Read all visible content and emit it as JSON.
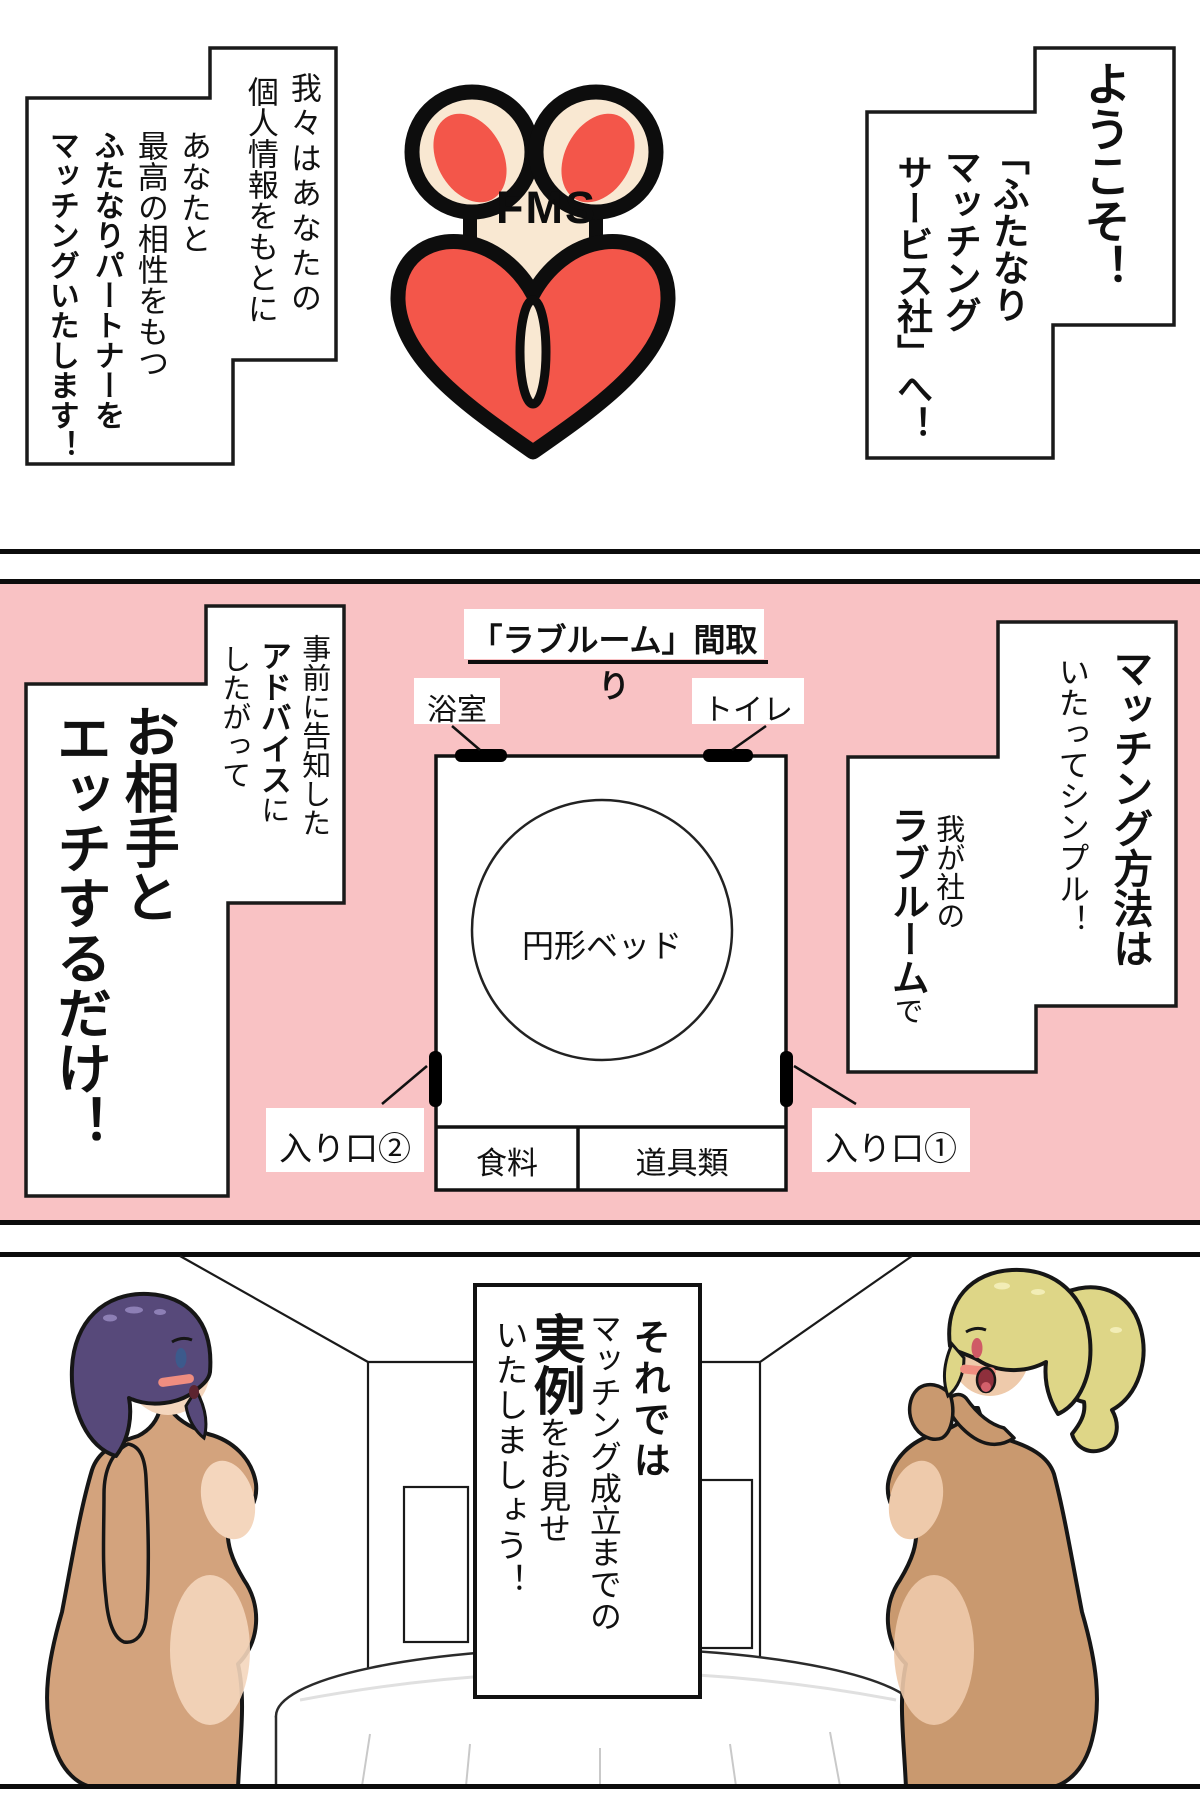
{
  "colors": {
    "panel_pink": "#f9c2c4",
    "logo_red": "#f3564a",
    "logo_cream": "#f9e8d2",
    "hair_purple": "#57497a",
    "hair_blonde": "#ded687",
    "skin_tan_left": "#d3a37d",
    "skin_light_left": "#f4d6bd",
    "skin_tan_right": "#c9996f",
    "skin_light_right": "#eecaab"
  },
  "panel1": {
    "welcome_bubble": {
      "col1": "ようこそ！",
      "col2": "「ふたなり",
      "col3": "マッチング",
      "col4": "サービス社」へ！"
    },
    "logo": {
      "monogram": "FMS"
    },
    "intro_bubble": {
      "col1": "我々はあなたの",
      "col2": "個人情報をもとに",
      "col3": "あなたと",
      "col4": "最高の相性をもつ",
      "col5": "ふたなりパートナーを",
      "col6": "マッチングいたします！"
    }
  },
  "panel2": {
    "title": "「ラブルーム」間取り",
    "floorplan": {
      "bathroom": "浴室",
      "toilet": "トイレ",
      "bed": "円形ベッド",
      "entrance2": "入り口②",
      "food": "食料",
      "tools": "道具類",
      "entrance1": "入り口①"
    },
    "method_bubble": {
      "col1_bold": "マッチング方法は",
      "col2": "いたってシンプル！",
      "col3": "我が社の",
      "col4_bold": "ラブルーム",
      "col4_tail": "で"
    },
    "advice_bubble": {
      "col1": "事前に告知した",
      "col2_bold": "アドバイス",
      "col2_tail": "に",
      "col3": "したがって",
      "col4": "お相手と",
      "col5": "エッチするだけ！"
    }
  },
  "panel3": {
    "announce_box": {
      "col1": "それでは",
      "col2": "マッチング成立までの",
      "col3_bold": "実例",
      "col3_tail": "をお見せ",
      "col4": "いたしましょう！"
    }
  }
}
